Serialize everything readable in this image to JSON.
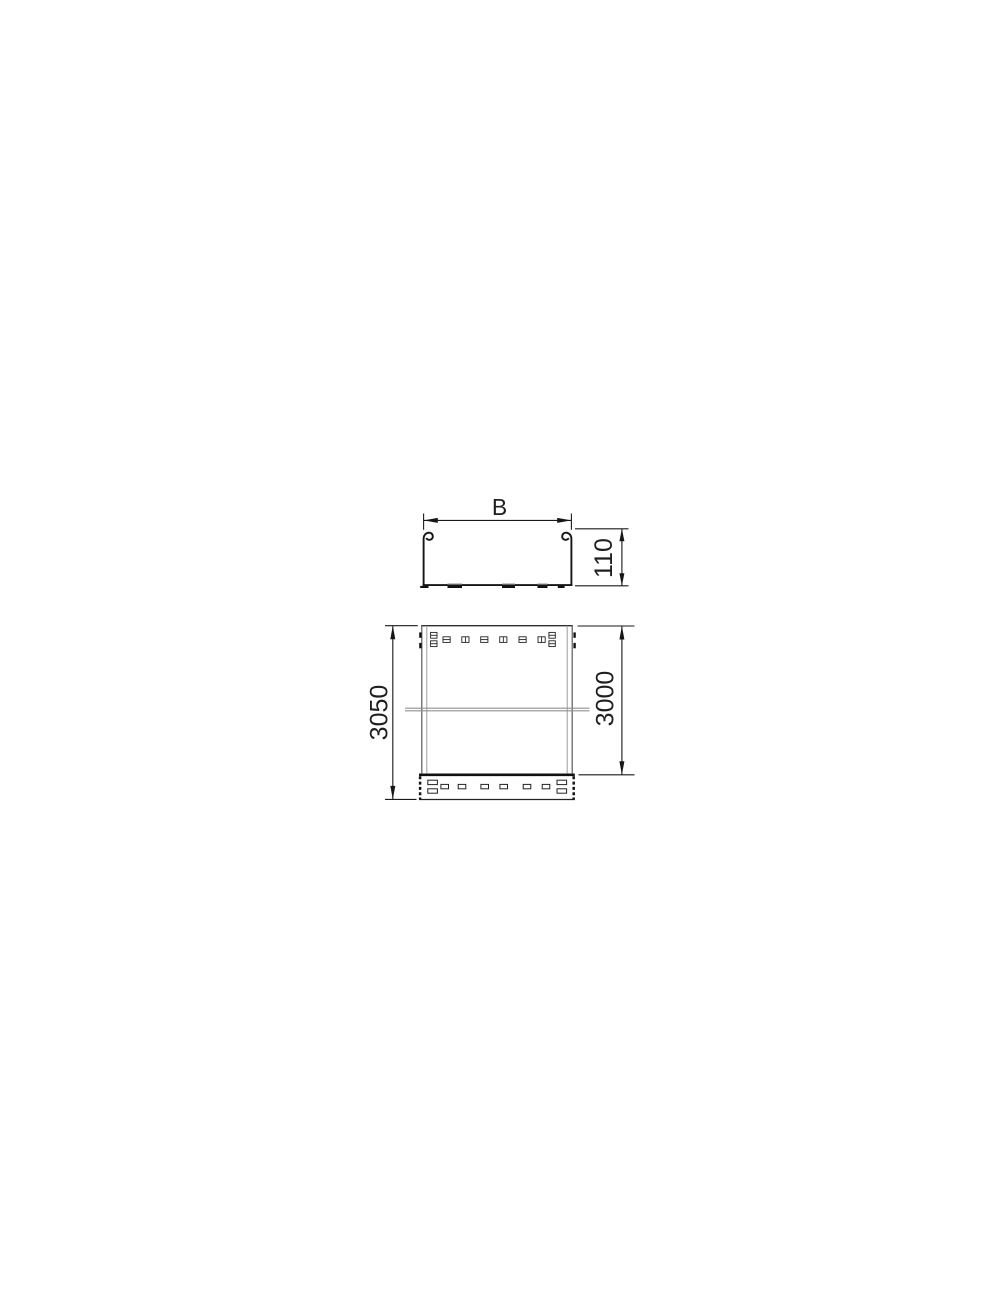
{
  "drawing": {
    "labels": {
      "width": "B",
      "height": "110",
      "length_total": "3050",
      "length_nominal": "3000"
    },
    "colors": {
      "line": "#1a1a1a",
      "light_line": "#8f8f8f",
      "background": "#ffffff"
    }
  }
}
